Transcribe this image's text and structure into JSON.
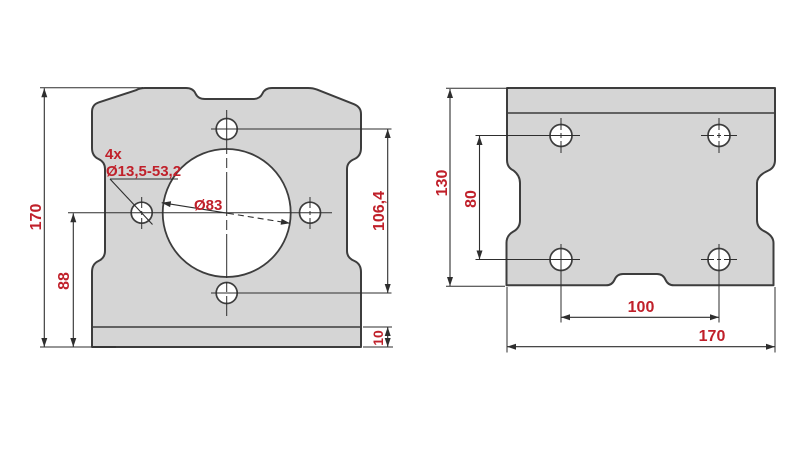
{
  "colors": {
    "dimension_red": "#c0202a",
    "plate_fill": "#d5d5d5",
    "outline_gray": "#3d3d3d",
    "dim_line_gray": "#2e2e2e",
    "background": "#ffffff"
  },
  "front_view": {
    "dims": {
      "overall_height": "170",
      "side_hole_height": "88",
      "vertical_hole_pitch": "106,4",
      "base_strip_thickness": "10"
    },
    "annotations": {
      "hole_count": "4x",
      "hole_spec": "Ø13,5-53,2",
      "bore_diameter": "Ø83"
    }
  },
  "side_view": {
    "dims": {
      "overall_depth": "130",
      "hole_row_pitch": "80",
      "hole_column_pitch": "100",
      "overall_width": "170"
    }
  }
}
